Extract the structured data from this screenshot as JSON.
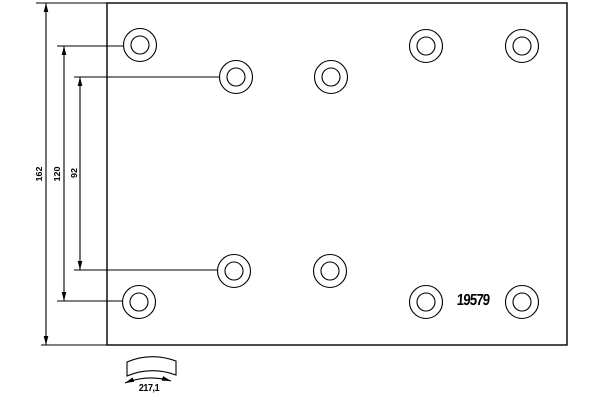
{
  "drawing_labels": {
    "part_number": "19579",
    "total_height": "162",
    "outer_hole_spacing": "120",
    "inner_hole_spacing": "92",
    "arc_width": "217,1"
  },
  "drawing": {
    "background": "#ffffff",
    "stroke": "#000000",
    "plate": {
      "x": 107,
      "y": 3,
      "width": 460,
      "height": 342
    },
    "holes": {
      "outer_radius": 16.5,
      "inner_radius": 9,
      "centers": [
        [
          140,
          45
        ],
        [
          236,
          77
        ],
        [
          331,
          77
        ],
        [
          426,
          46
        ],
        [
          522,
          46
        ],
        [
          139,
          302
        ],
        [
          234,
          271
        ],
        [
          330,
          271
        ],
        [
          426,
          302
        ],
        [
          522,
          302
        ]
      ]
    },
    "dimensions": [
      {
        "name": "total-height",
        "label": "162",
        "x": 46,
        "y1": 3,
        "y2": 345,
        "extensions": [
          [
            36,
            3,
            107,
            3
          ],
          [
            41,
            345,
            107,
            345
          ]
        ]
      },
      {
        "name": "outer-hole-spacing",
        "label": "120",
        "x": 64,
        "y1": 46,
        "y2": 301,
        "extensions": [
          [
            57,
            46,
            123,
            46
          ],
          [
            57,
            301,
            122,
            301
          ]
        ]
      },
      {
        "name": "inner-hole-spacing",
        "label": "92",
        "x": 80,
        "y1": 77,
        "y2": 270,
        "extensions": [
          [
            74,
            77,
            219,
            77
          ],
          [
            74,
            270,
            217,
            270
          ]
        ]
      }
    ],
    "arc_symbol": {
      "band_path": "M127,362 Q151,352 176,361 L176,375 Q151,366 127,376 Z",
      "dim_path": "M125,383 Q148,374 171,381",
      "arrows": [
        {
          "x": 125,
          "y": 383,
          "angle": 158
        },
        {
          "x": 171,
          "y": 381,
          "angle": 17
        }
      ]
    }
  }
}
